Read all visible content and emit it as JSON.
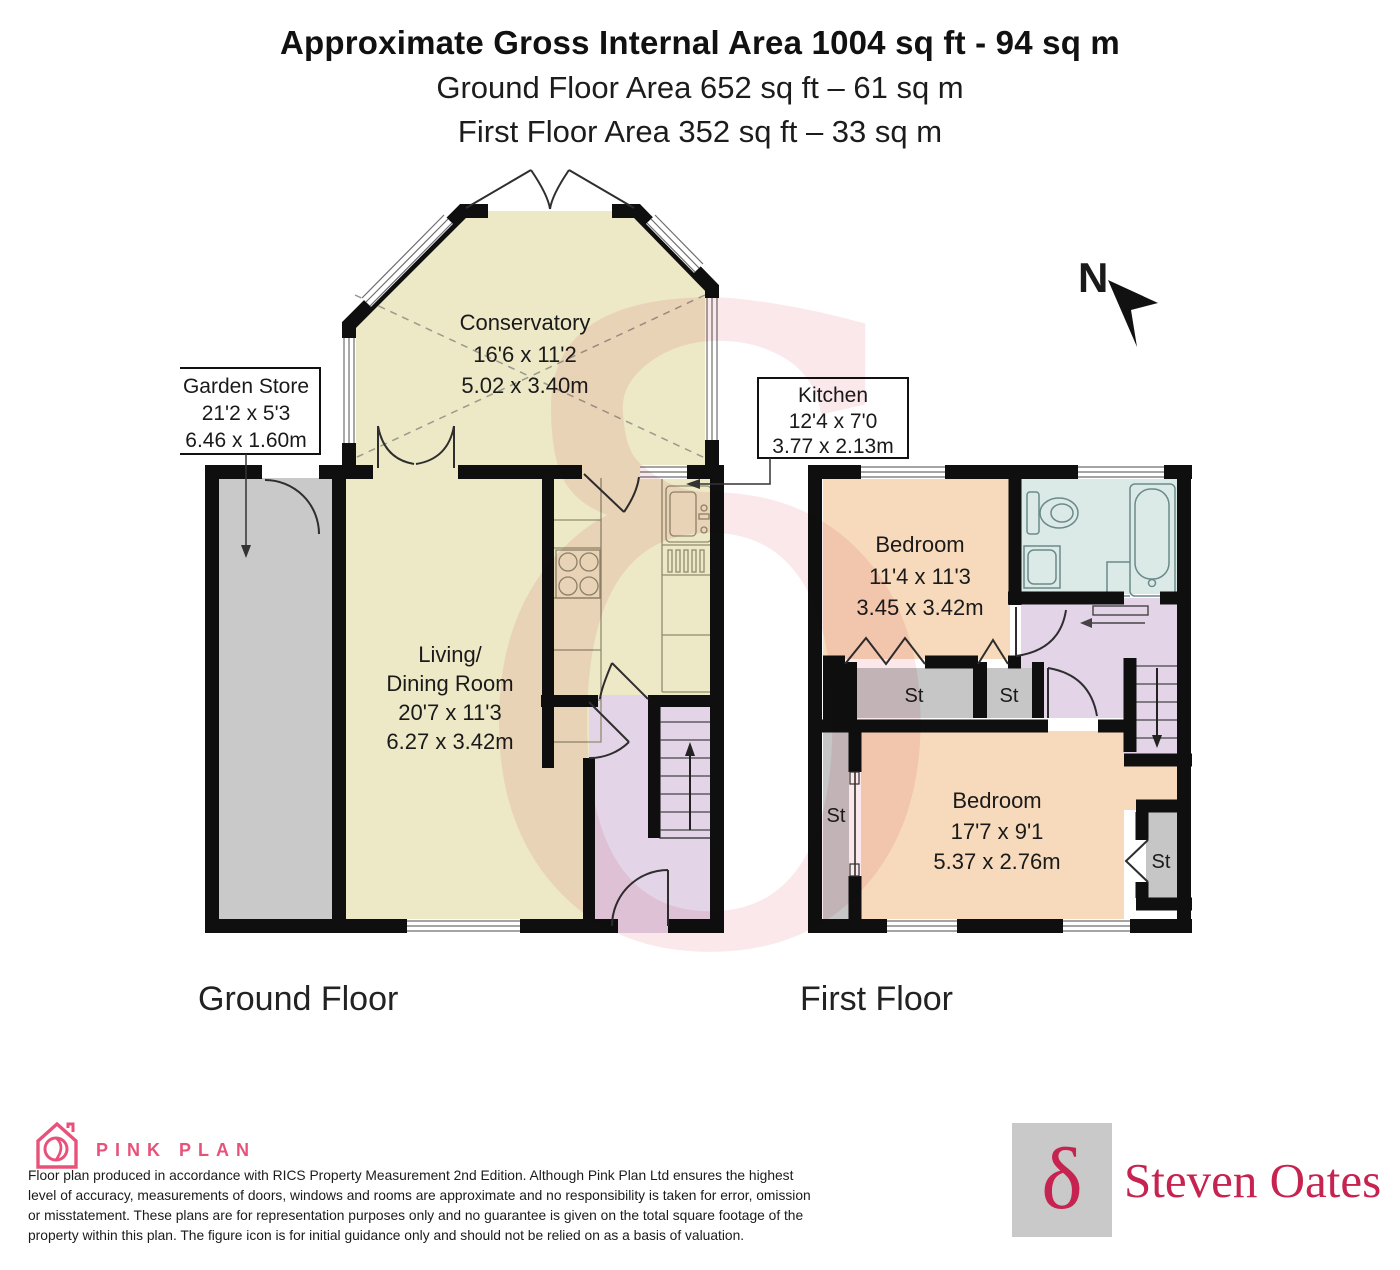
{
  "header": {
    "title_bold": "Approximate Gross Internal Area 1004 sq ft - 94 sq m",
    "subtitle_ground": "Ground Floor Area 652 sq ft – 61 sq m",
    "subtitle_first": "First Floor Area 352 sq ft – 33 sq m"
  },
  "compass": {
    "label": "N"
  },
  "ground_floor": {
    "caption": "Ground Floor",
    "conservatory": {
      "name": "Conservatory",
      "imperial": "16'6 x 11'2",
      "metric": "5.02 x 3.40m"
    },
    "garden_store": {
      "name": "Garden Store",
      "imperial": "21'2 x 5'3",
      "metric": "6.46 x 1.60m"
    },
    "kitchen": {
      "name": "Kitchen",
      "imperial": "12'4 x 7'0",
      "metric": "3.77 x 2.13m"
    },
    "living": {
      "name_line1": "Living/",
      "name_line2": "Dining Room",
      "imperial": "20'7 x 11'3",
      "metric": "6.27 x 3.42m"
    }
  },
  "first_floor": {
    "caption": "First Floor",
    "bedroom1": {
      "name": "Bedroom",
      "imperial": "11'4 x 11'3",
      "metric": "3.45 x 3.42m"
    },
    "bedroom2": {
      "name": "Bedroom",
      "imperial": "17'7 x 9'1",
      "metric": "5.37 x 2.76m"
    },
    "storage_label": "St"
  },
  "watermark": {
    "glyph": "δ"
  },
  "footer": {
    "pink_plan": {
      "brand": "PINK PLAN"
    },
    "disclaimer": {
      "line1": "Floor plan produced in accordance with RICS Property Measurement 2nd Edition. Although Pink Plan Ltd ensures the highest",
      "line2": "level of accuracy, measurements of doors, windows and rooms are approximate and no responsibility is taken for error, omission",
      "line3": "or misstatement. These plans are for representation purposes only and no guarantee is given on the total square footage of the",
      "line4": "property within this plan. The figure icon is for initial guidance only and should not be relied on as a basis of valuation."
    },
    "agency": {
      "glyph": "δ",
      "name": "Steven Oates"
    }
  },
  "colors": {
    "brand_pink": "#E8527A",
    "agency_red": "#C62350",
    "room_cream": "#EDE8C6",
    "room_peach": "#F7DABC",
    "room_purple": "#E4D4E8",
    "room_blue": "#DBE9E7",
    "room_gray": "#C9C9C9",
    "wall_black": "#0F0F0F"
  }
}
